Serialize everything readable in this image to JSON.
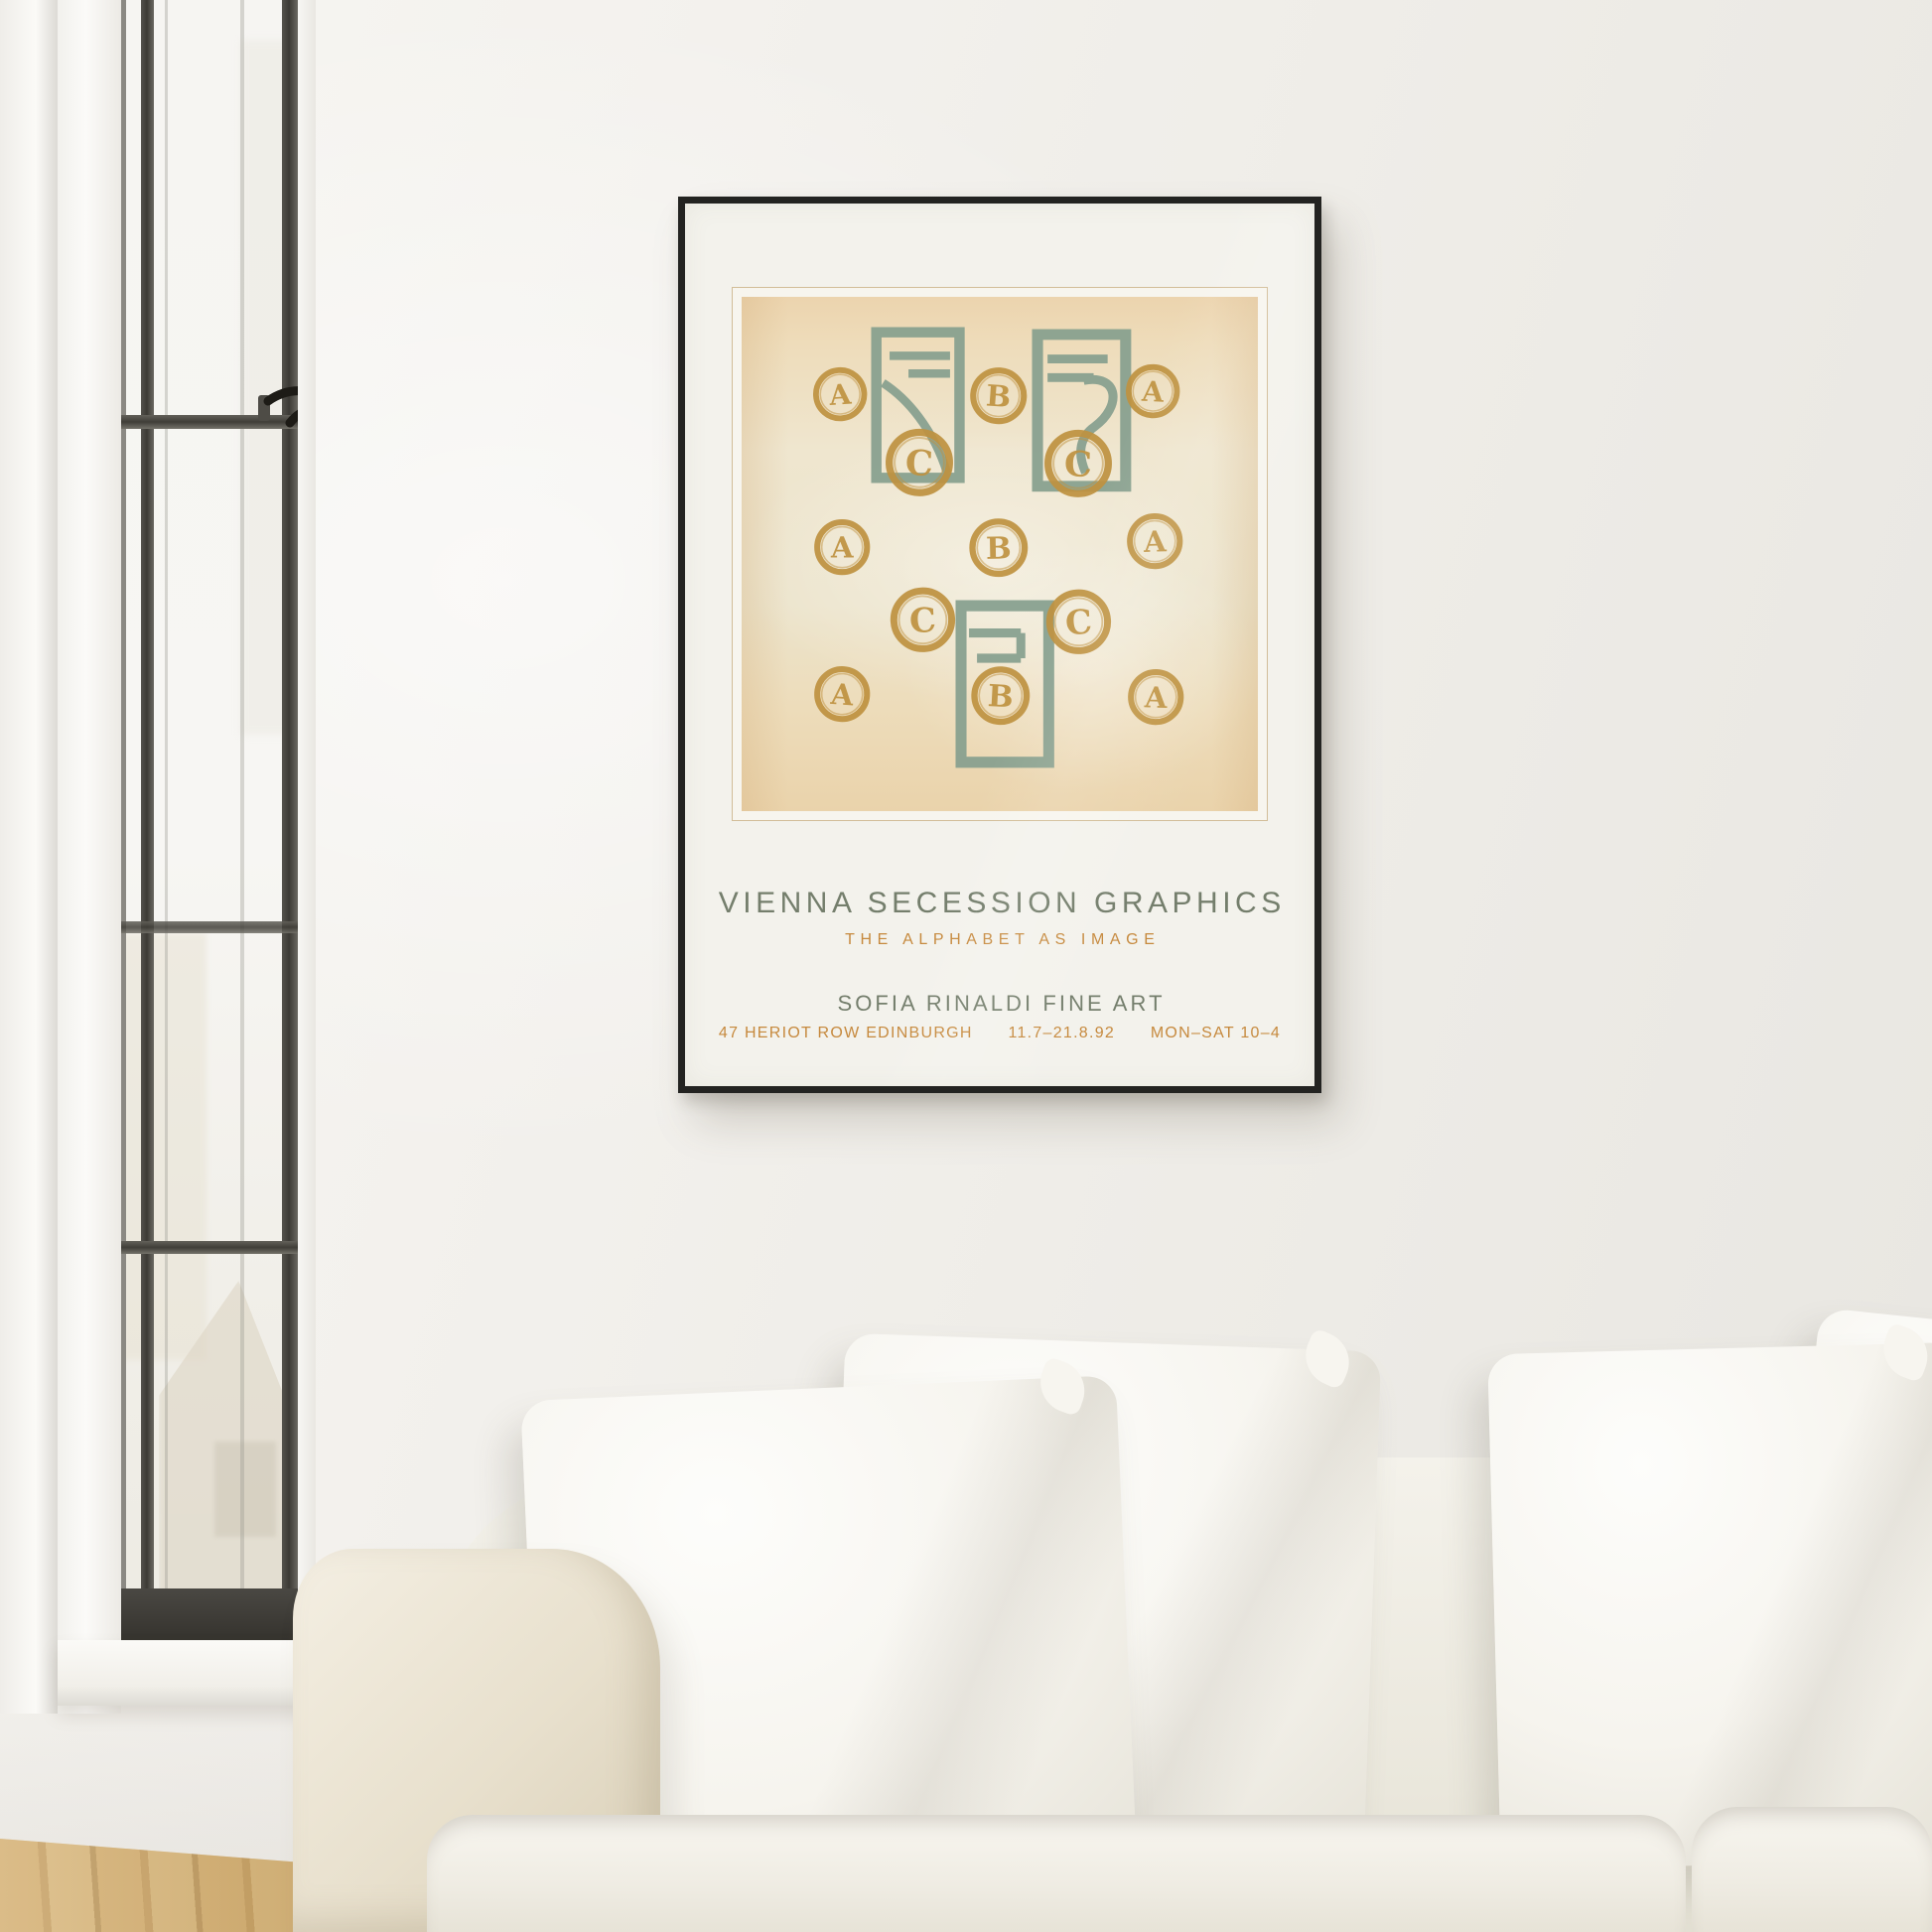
{
  "scene": {
    "description": "Bright living room: framed Vienna Secession exhibition poster on a white wall above a white slip-cover sofa, steel-frame window at left, oak floor",
    "window_label": "steel-frame casement window",
    "floor_label": "oak parquet floor",
    "sofa_label": "white linen sofa with throw pillows"
  },
  "poster": {
    "title": "VIENNA SECESSION GRAPHICS",
    "subtitle": "THE ALPHABET AS IMAGE",
    "gallery": "SOFIA RINALDI FINE ART",
    "address_segments": [
      "47 HERIOT ROW EDINBURGH",
      "11.7–21.8.92",
      "MON–SAT 10–4"
    ],
    "colors": {
      "text_green": "#747e6c",
      "text_orange": "#c6893d",
      "ink_green": "#87a08f",
      "ink_ochre": "#bf9240",
      "artwork_bg": "#eedcbd",
      "mat": "#f3f2ec",
      "frame": "#232321"
    },
    "artwork": {
      "frames": [
        {
          "variant": "curve",
          "x": 25.0,
          "y": 5.8,
          "w": 18.3,
          "h": 30.5
        },
        {
          "variant": "wave",
          "x": 56.2,
          "y": 6.2,
          "w": 19.4,
          "h": 31.8
        },
        {
          "variant": "zigzag",
          "x": 41.3,
          "y": 58.9,
          "w": 19.3,
          "h": 32.8
        }
      ],
      "letters": [
        {
          "glyph": "A",
          "x": 19.0,
          "y": 18.9,
          "d": 12.0
        },
        {
          "glyph": "B",
          "x": 49.8,
          "y": 19.3,
          "d": 12.6
        },
        {
          "glyph": "A",
          "x": 79.6,
          "y": 18.3,
          "d": 12.0
        },
        {
          "glyph": "C",
          "x": 34.4,
          "y": 32.2,
          "d": 15.0
        },
        {
          "glyph": "C",
          "x": 65.2,
          "y": 32.4,
          "d": 15.0
        },
        {
          "glyph": "A",
          "x": 19.5,
          "y": 48.6,
          "d": 12.4
        },
        {
          "glyph": "B",
          "x": 49.8,
          "y": 48.8,
          "d": 13.0
        },
        {
          "glyph": "A",
          "x": 80.0,
          "y": 47.5,
          "d": 12.4
        },
        {
          "glyph": "C",
          "x": 35.0,
          "y": 62.8,
          "d": 14.4
        },
        {
          "glyph": "C",
          "x": 65.2,
          "y": 63.1,
          "d": 14.4
        },
        {
          "glyph": "A",
          "x": 19.5,
          "y": 77.3,
          "d": 12.4
        },
        {
          "glyph": "B",
          "x": 50.2,
          "y": 77.6,
          "d": 13.0
        },
        {
          "glyph": "A",
          "x": 80.3,
          "y": 77.8,
          "d": 12.4
        }
      ]
    }
  }
}
